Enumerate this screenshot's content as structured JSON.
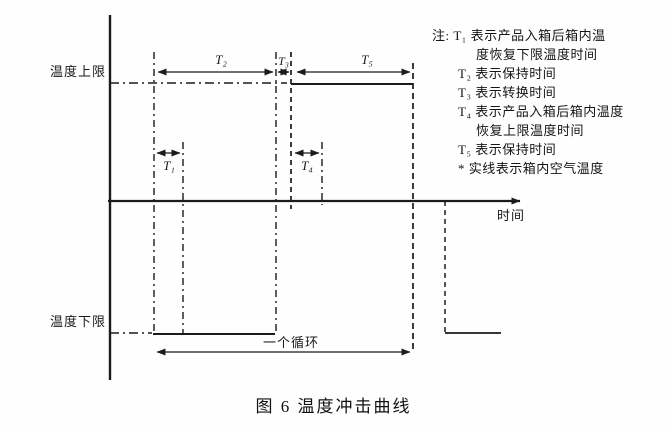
{
  "figure": {
    "caption": "图 6  温度冲击曲线",
    "axis": {
      "y_upper_label": "温度上限",
      "y_lower_label": "温度下限",
      "x_label": "时间"
    },
    "intervals": {
      "t1": "T₁",
      "t2": "T₂",
      "t3": "T₃",
      "t4": "T₄",
      "t5": "T₅"
    },
    "cycle_label": "一个循环",
    "notes": {
      "lines": [
        {
          "text": "注: T₁ 表示产品入箱后箱内温"
        },
        {
          "text": "度恢复下限温度时间"
        },
        {
          "text": "T₂ 表示保持时间"
        },
        {
          "text": "T₃ 表示转换时间"
        },
        {
          "text": "T₄ 表示产品入箱后箱内温度"
        },
        {
          "text": "恢复上限温度时间"
        },
        {
          "text": "T₅ 表示保持时间"
        },
        {
          "text": "* 实线表示箱内空气温度"
        }
      ]
    }
  },
  "colors": {
    "ink": "#1b1b1b",
    "background": "#ffffff"
  }
}
